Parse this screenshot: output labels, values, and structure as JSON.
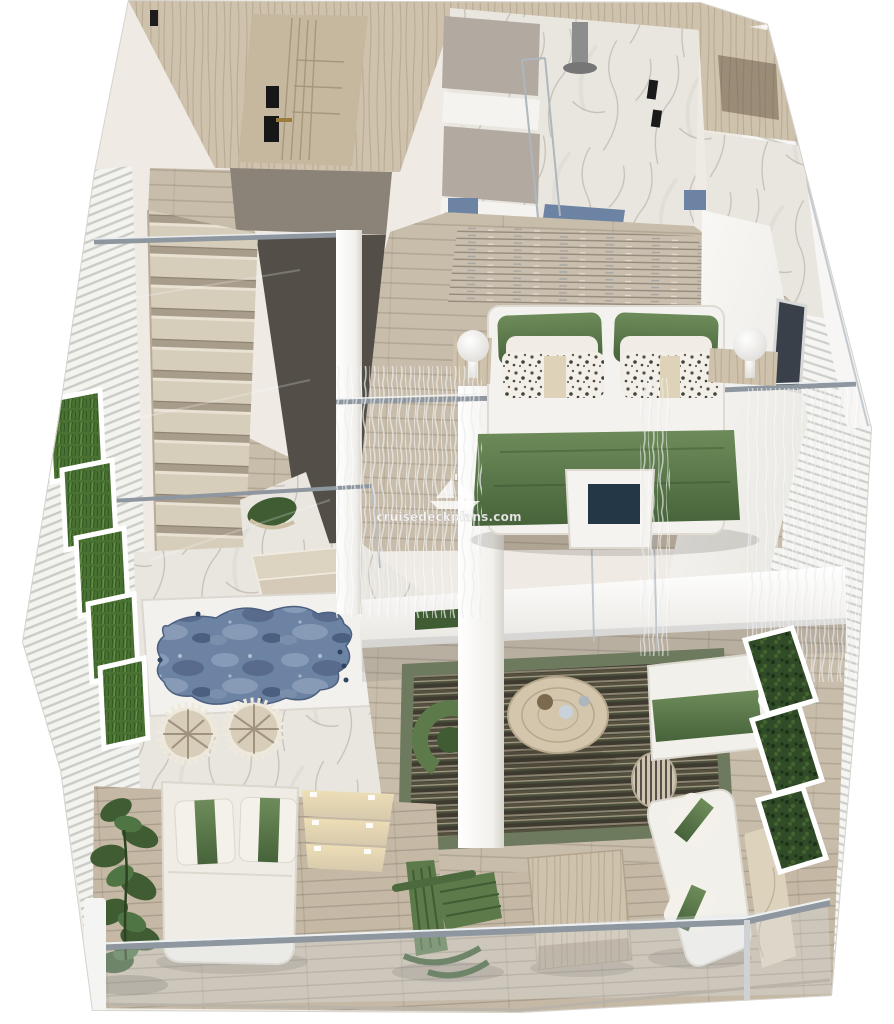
{
  "scene": {
    "watermark": {
      "text": "cruisedeckplans.com",
      "icon": "sailing-ship-icon"
    },
    "palette": {
      "background": "#ffffff",
      "wood_wall": "#cfc2ac",
      "wood_door": "#c6b89f",
      "plank": "#c8bcaa",
      "deck": "#c5b9a6",
      "marble": "#e9e6e0",
      "marble_vein": "#c0bab1",
      "marble_beige": "#ddd2bc",
      "dark_panel": "#534f48",
      "gray_block": "#8b8377",
      "cabinet_gray": "#b2a9a1",
      "green": "#5c7a4a",
      "green_dark": "#3f5c33",
      "hedge": "#2f4b27",
      "water": "#6d83a4",
      "metal": "#8e979f",
      "white_wall": "#f7f6f3",
      "rug_dark": "#3e3a30"
    }
  }
}
